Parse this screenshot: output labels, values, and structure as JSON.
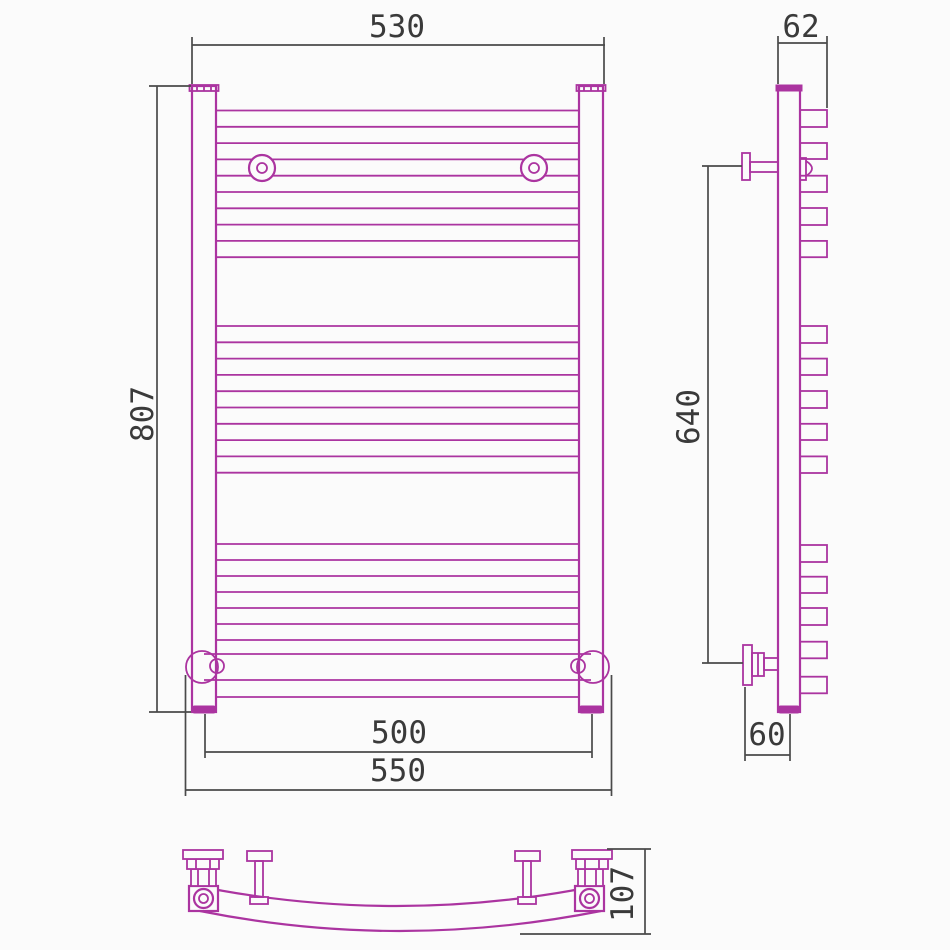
{
  "drawing_type": "technical-drawing",
  "subject": "heated towel rail (3 orthographic views: front, side, top)",
  "colors": {
    "drawing": "#ab34a0",
    "dimension_lines": "#4a4a4a",
    "dimension_text": "#3a3a3a",
    "background": "#fbfbfb"
  },
  "dimensions": {
    "front_top_width": "530",
    "front_height": "807",
    "front_rail_length": "500",
    "front_overall_width": "550",
    "side_top_depth": "62",
    "side_bracket_span": "640",
    "side_bottom_depth": "60",
    "top_view_depth": "107"
  },
  "geometry": {
    "front_rungs_y": [
      110.5,
      126.8,
      143.1,
      159.4,
      175.7,
      192,
      208.3,
      224.6,
      240.9,
      257.2,
      326,
      342.3,
      358.6,
      374.9,
      391.2,
      407.5,
      423.8,
      440.1,
      456.4,
      472.7,
      544,
      560,
      576,
      592,
      608,
      624,
      640,
      697
    ],
    "front_rung_x": [
      216,
      579
    ],
    "side_stubs": [
      [
        110,
        127
      ],
      [
        143,
        159
      ],
      [
        175.7,
        192
      ],
      [
        208,
        225
      ],
      [
        240.9,
        257.2
      ],
      [
        326,
        343
      ],
      [
        358.6,
        375
      ],
      [
        391,
        408
      ],
      [
        423.8,
        440
      ],
      [
        456.4,
        473
      ],
      [
        545,
        562
      ],
      [
        576.7,
        593
      ],
      [
        608,
        625
      ],
      [
        641.7,
        658.3
      ],
      [
        676.7,
        693.3
      ]
    ],
    "side_stub_x": [
      800,
      827
    ]
  }
}
